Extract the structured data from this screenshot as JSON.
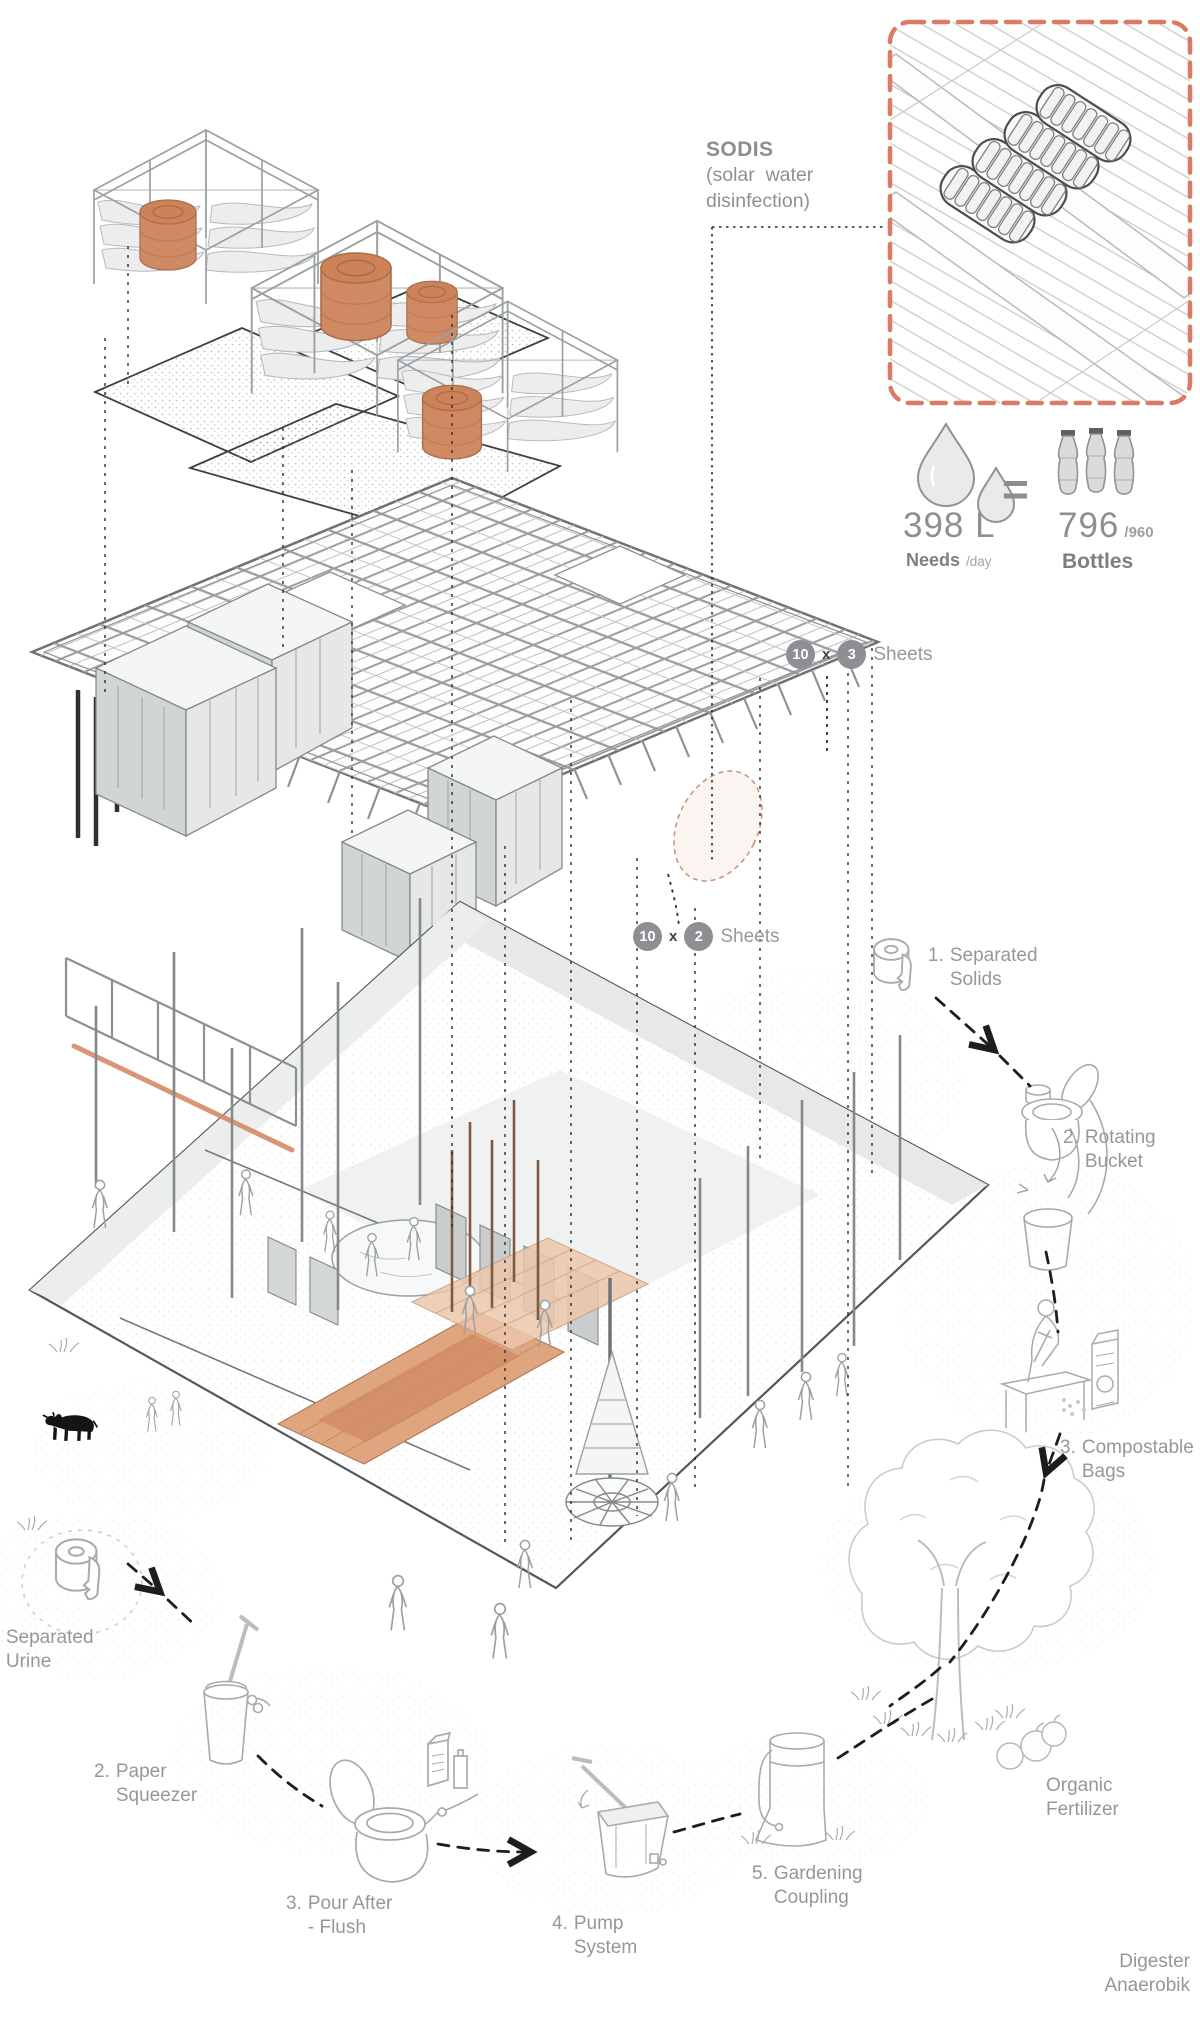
{
  "page": {
    "title": "Sanitation and water reuse system — exploded axonometric diagram"
  },
  "colors": {
    "accent_dashed": "#dd7a66",
    "terracotta": "#d2845f",
    "badge_gray": "#8d8f92",
    "text_gray": "#96979a"
  },
  "sodis": {
    "title": "SODIS",
    "subtitle_line1": "(solar  water",
    "subtitle_line2": "disinfection)"
  },
  "water_equation": {
    "needs_value": "398 L",
    "needs_label": "Needs",
    "needs_unit": "/day",
    "equals": "=",
    "bottles_value": "796",
    "bottles_total": "/960",
    "bottles_label": "Bottles"
  },
  "sheets": {
    "top": {
      "count_a": "10",
      "times": "x",
      "count_b": "3",
      "label": "Sheets"
    },
    "bottom": {
      "count_a": "10",
      "times": "x",
      "count_b": "2",
      "label": "Sheets"
    }
  },
  "solids_flow": [
    {
      "num": "1.",
      "text": "Separated Solids"
    },
    {
      "num": "2.",
      "text": "Rotating Bucket"
    },
    {
      "num": "3.",
      "text": "Compostable Bags"
    }
  ],
  "urine_flow": [
    {
      "num": "1.",
      "text": "Separated Urine"
    },
    {
      "num": "2.",
      "text": "Paper Squeezer"
    },
    {
      "num": "3.",
      "text": "Pour After - Flush"
    },
    {
      "num": "4.",
      "text": "Pump System"
    },
    {
      "num": "5.",
      "text": "Gardening Coupling"
    }
  ],
  "outputs": {
    "organic_fertilizer": "Organic Fertilizer",
    "digester": "Digester Anaerobik"
  },
  "icons": {
    "water_drops": "water-drops-icon",
    "pet_bottles": "pet-bottles-icon",
    "toilet_paper": "toilet-paper-roll-icon",
    "rotating_bucket": "rotating-bucket-icon",
    "compost_bagging": "compost-bagging-icon",
    "tree": "tree-icon",
    "cow": "cow-icon",
    "paper_squeezer": "paper-squeezer-icon",
    "pour_flush_toilet": "pour-flush-toilet-icon",
    "pump": "pump-system-icon",
    "garden_barrel": "garden-barrel-icon",
    "fruits": "fruit-icons",
    "sodis_detail": "sodis-roof-bottles-detail"
  }
}
